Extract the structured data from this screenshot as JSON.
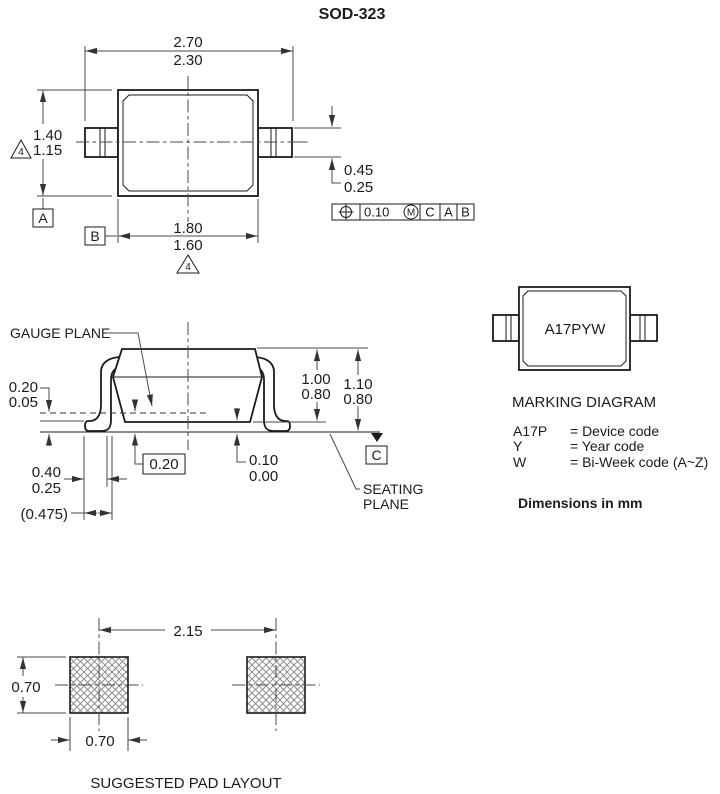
{
  "title": "SOD-323",
  "colors": {
    "line": "#1b1b1b",
    "dim_line": "#4a4a4a",
    "background": "#ffffff",
    "hatch": "#8f8f8f"
  },
  "top_view": {
    "overall_width_max": "2.70",
    "overall_width_min": "2.30",
    "overall_height_max": "1.40",
    "overall_height_min": "1.15",
    "body_width_max": "1.80",
    "body_width_min": "1.60",
    "lead_width_max": "0.45",
    "lead_width_min": "0.25",
    "note_4_left": "4",
    "note_4_bottom": "4",
    "datum_a": "A",
    "datum_b": "B",
    "fcf_tolerance": "0.10",
    "fcf_modifier": "M",
    "fcf_datum_1": "C",
    "fcf_datum_2": "A",
    "fcf_datum_3": "B"
  },
  "side_view": {
    "gauge_plane_label": "GAUGE PLANE",
    "gauge_standoff_max": "0.20",
    "gauge_standoff_min": "0.05",
    "body_height_max": "1.00",
    "body_height_min": "0.80",
    "total_height_max": "1.10",
    "total_height_min": "0.80",
    "lead_thickness_basic": "0.20",
    "standoff_max": "0.10",
    "standoff_min": "0.00",
    "datum_c": "C",
    "seating_plane_line1": "SEATING",
    "seating_plane_line2": "PLANE",
    "foot_length_max": "0.40",
    "foot_length_min": "0.25",
    "lead_ref": "(0.475)"
  },
  "marking": {
    "package_marking": "A17PYW",
    "heading": "MARKING DIAGRAM",
    "legend": [
      {
        "code": "A17P",
        "meaning": "= Device code"
      },
      {
        "code": "Y",
        "meaning": "= Year code"
      },
      {
        "code": "W",
        "meaning": "= Bi-Week code (A~Z)"
      }
    ],
    "units_note": "Dimensions in mm"
  },
  "pad_layout": {
    "pad_pitch": "2.15",
    "pad_height": "0.70",
    "pad_width": "0.70",
    "caption": "SUGGESTED PAD LAYOUT"
  }
}
